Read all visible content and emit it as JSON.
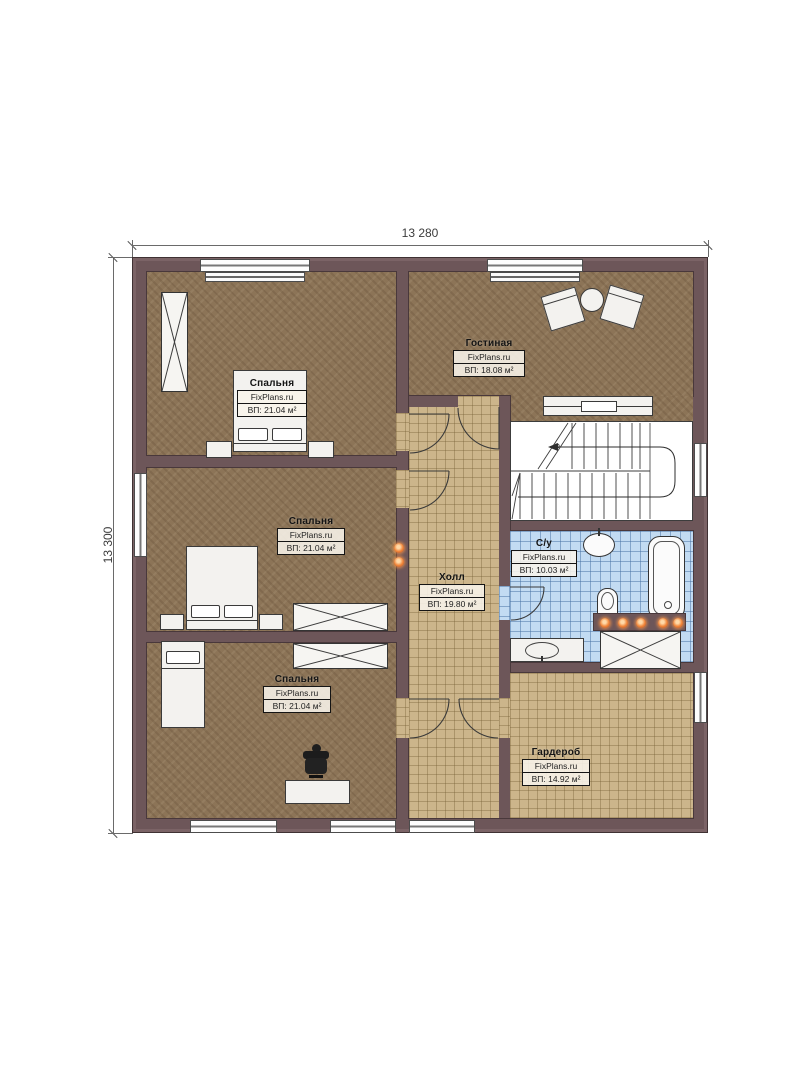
{
  "dimensions": {
    "width_top": "13 280",
    "height_left": "13 300"
  },
  "rooms": {
    "bedroom1": {
      "name": "Спальня",
      "brand": "FixPlans.ru",
      "area": "ВП: 21.04 м²"
    },
    "bedroom2": {
      "name": "Спальня",
      "brand": "FixPlans.ru",
      "area": "ВП: 21.04 м²"
    },
    "bedroom3": {
      "name": "Спальня",
      "brand": "FixPlans.ru",
      "area": "ВП: 21.04 м²"
    },
    "living": {
      "name": "Гостиная",
      "brand": "FixPlans.ru",
      "area": "ВП: 18.08 м²"
    },
    "hall": {
      "name": "Холл",
      "brand": "FixPlans.ru",
      "area": "ВП: 19.80 м²"
    },
    "bathroom": {
      "name": "С/у",
      "brand": "FixPlans.ru",
      "area": "ВП: 10.03 м²"
    },
    "wardrobe": {
      "name": "Гардероб",
      "brand": "FixPlans.ru",
      "area": "ВП: 14.92 м²"
    }
  },
  "colors": {
    "wall": "#6d5659",
    "bedroom_floor": "#8c7457",
    "hall_floor": "#ccb58b",
    "bathroom_floor": "#c2dbf2",
    "light_accent": "#f08438"
  }
}
